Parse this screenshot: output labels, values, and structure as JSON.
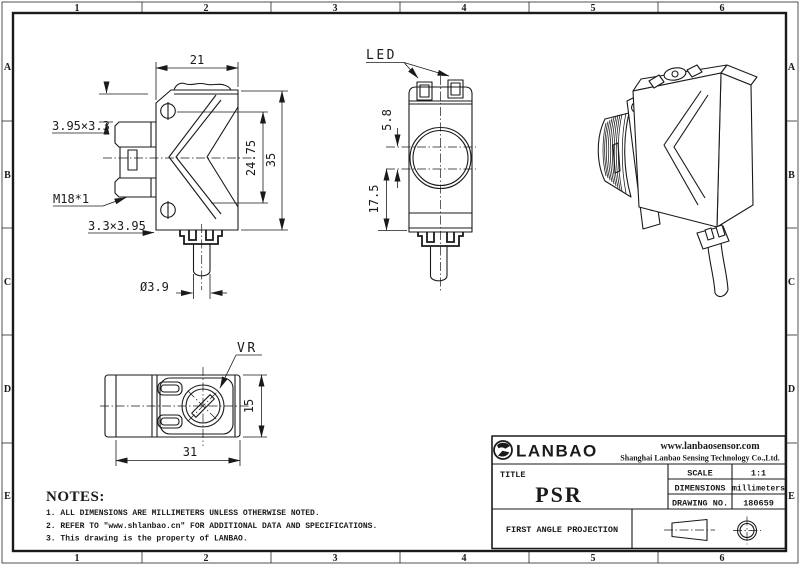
{
  "grid": {
    "cols": [
      "1",
      "2",
      "3",
      "4",
      "5",
      "6"
    ],
    "rows": [
      "A",
      "B",
      "C",
      "D",
      "E"
    ]
  },
  "front_view": {
    "dim_width": "21",
    "dim_slot_top": "3.95×3.3",
    "dim_thread": "M18*1",
    "dim_slot_bottom": "3.3×3.95",
    "dim_cable": "Ø3.9",
    "dim_inner_height": "24.75",
    "dim_height": "35"
  },
  "side_view": {
    "label_led": "LED",
    "dim_led_offset": "5.8",
    "dim_lens_height": "17.5"
  },
  "bottom_view": {
    "label_vr": "VR",
    "dim_height": "15",
    "dim_width": "31"
  },
  "notes": {
    "heading": "NOTES:",
    "items": [
      "1. ALL DIMENSIONS ARE MILLIMETERS UNLESS OTHERWISE NOTED.",
      "2. REFER TO \"www.shlanbao.cn\" FOR ADDITIONAL DATA AND SPECIFICATIONS.",
      "3. This drawing is the property of LANBAO."
    ]
  },
  "title_block": {
    "brand": "LANBAO",
    "website": "www.lanbaosensor.com",
    "company": "Shanghai Lanbao Sensing Technology Co.,Ltd.",
    "title_label": "TITLE",
    "title": "PSR",
    "scale_label": "SCALE",
    "scale_value": "1:1",
    "dimensions_label": "DIMENSIONS",
    "dimensions_value": "millimeters",
    "drawing_no_label": "DRAWING NO.",
    "drawing_no_value": "180659",
    "projection_label": "FIRST ANGLE PROJECTION"
  },
  "colors": {
    "line": "#1a1a1a",
    "bg": "#ffffff"
  }
}
